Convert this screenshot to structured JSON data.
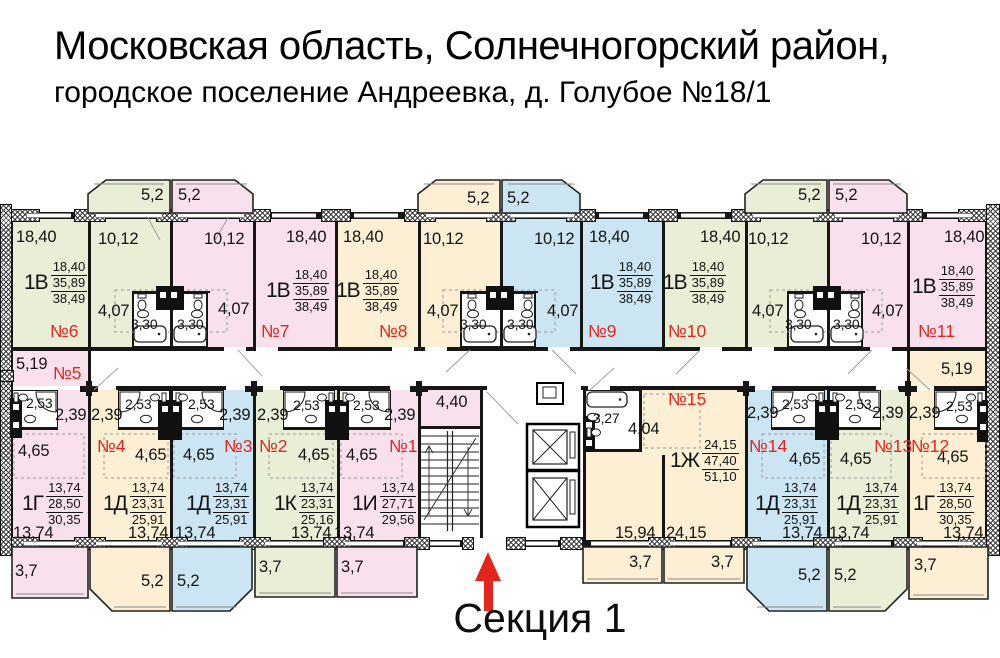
{
  "title": {
    "line1": "Московская область, Солнечногорский район,",
    "line2": "городское поселение Андреевка, д. Голубое №18/1"
  },
  "section": {
    "label": "Секция 1"
  },
  "palette": {
    "pink": "#f9e0ed",
    "green": "#e9eed7",
    "beige": "#fcefd3",
    "blue": "#cbe5f3",
    "red": "#e4251e",
    "wall": "#161616"
  },
  "apartments": [
    {
      "number": "№1",
      "type": "1И",
      "areas": [
        "13,74",
        "27,71",
        "29,56"
      ],
      "color": "pink"
    },
    {
      "number": "№2",
      "type": "1К",
      "areas": [
        "13,74",
        "23,31",
        "25,16"
      ],
      "color": "green"
    },
    {
      "number": "№3",
      "type": "1Д",
      "areas": [
        "13,74",
        "23,31",
        "25,91"
      ],
      "color": "blue"
    },
    {
      "number": "№4",
      "type": "1Д",
      "areas": [
        "13,74",
        "23,31",
        "25,91"
      ],
      "color": "beige"
    },
    {
      "number": "№5",
      "type": "1Г",
      "areas": [
        "13,74",
        "28,50",
        "30,35"
      ],
      "color": "pink"
    },
    {
      "number": "№6",
      "type": "1В",
      "areas": [
        "18,40",
        "35,89",
        "38,49"
      ],
      "color": "green"
    },
    {
      "number": "№7",
      "type": "1В",
      "areas": [
        "18,40",
        "35,89",
        "38,49"
      ],
      "color": "pink"
    },
    {
      "number": "№8",
      "type": "1В",
      "areas": [
        "18,40",
        "35,89",
        "38,49"
      ],
      "color": "beige"
    },
    {
      "number": "№9",
      "type": "1В",
      "areas": [
        "18,40",
        "35,89",
        "38,49"
      ],
      "color": "blue"
    },
    {
      "number": "№10",
      "type": "1В",
      "areas": [
        "18,40",
        "35,89",
        "38,49"
      ],
      "color": "green"
    },
    {
      "number": "№11",
      "type": "1В",
      "areas": [
        "18,40",
        "35,89",
        "38,49"
      ],
      "color": "pink"
    },
    {
      "number": "№12",
      "type": "1Г",
      "areas": [
        "13,74",
        "28,50",
        "30,35"
      ],
      "color": "beige"
    },
    {
      "number": "№13",
      "type": "1Д",
      "areas": [
        "13,74",
        "23,31",
        "25,91"
      ],
      "color": "green"
    },
    {
      "number": "№14",
      "type": "1Д",
      "areas": [
        "13,74",
        "23,31",
        "25,91"
      ],
      "color": "blue"
    },
    {
      "number": "№15",
      "type": "1Ж",
      "areas": [
        "24,15",
        "47,40",
        "51,10"
      ],
      "color": "beige"
    }
  ],
  "labels": [
    {
      "t": "5,2",
      "x": 141,
      "y": 187
    },
    {
      "t": "5,2",
      "x": 178,
      "y": 187
    },
    {
      "t": "5,2",
      "x": 467,
      "y": 190
    },
    {
      "t": "5,2",
      "x": 507,
      "y": 190
    },
    {
      "t": "5,2",
      "x": 798,
      "y": 187
    },
    {
      "t": "5,2",
      "x": 835,
      "y": 187
    },
    {
      "t": "18,40",
      "x": 16,
      "y": 229
    },
    {
      "t": "10,12",
      "x": 98,
      "y": 231
    },
    {
      "t": "10,12",
      "x": 204,
      "y": 231
    },
    {
      "t": "18,40",
      "x": 286,
      "y": 229
    },
    {
      "t": "18,40",
      "x": 343,
      "y": 229
    },
    {
      "t": "10,12",
      "x": 423,
      "y": 231
    },
    {
      "t": "10,12",
      "x": 534,
      "y": 231
    },
    {
      "t": "18,40",
      "x": 589,
      "y": 229
    },
    {
      "t": "18,40",
      "x": 700,
      "y": 229
    },
    {
      "t": "10,12",
      "x": 748,
      "y": 231
    },
    {
      "t": "10,12",
      "x": 861,
      "y": 231
    },
    {
      "t": "18,40",
      "x": 944,
      "y": 229
    },
    {
      "t": "4,07",
      "x": 98,
      "y": 303
    },
    {
      "t": "3,30",
      "x": 131,
      "y": 317,
      "s": 14
    },
    {
      "t": "3,30",
      "x": 177,
      "y": 317,
      "s": 14
    },
    {
      "t": "4,07",
      "x": 218,
      "y": 301
    },
    {
      "t": "4,07",
      "x": 427,
      "y": 303
    },
    {
      "t": "3,30",
      "x": 460,
      "y": 317,
      "s": 14
    },
    {
      "t": "3,30",
      "x": 507,
      "y": 317,
      "s": 14
    },
    {
      "t": "4,07",
      "x": 547,
      "y": 303
    },
    {
      "t": "4,07",
      "x": 752,
      "y": 303
    },
    {
      "t": "3,30",
      "x": 785,
      "y": 317,
      "s": 14
    },
    {
      "t": "3,30",
      "x": 833,
      "y": 317,
      "s": 14
    },
    {
      "t": "4,07",
      "x": 872,
      "y": 303
    },
    {
      "t": "5,19",
      "x": 16,
      "y": 356
    },
    {
      "t": "5,19",
      "x": 941,
      "y": 361
    },
    {
      "t": "2,53",
      "x": 26,
      "y": 396,
      "s": 14
    },
    {
      "t": "2,39",
      "x": 55,
      "y": 407
    },
    {
      "t": "4,65",
      "x": 18,
      "y": 443
    },
    {
      "t": "13,74",
      "x": 13,
      "y": 525
    },
    {
      "t": "2,53",
      "x": 125,
      "y": 397,
      "s": 14
    },
    {
      "t": "2,39",
      "x": 91,
      "y": 407
    },
    {
      "t": "4,65",
      "x": 135,
      "y": 447
    },
    {
      "t": "13,74",
      "x": 128,
      "y": 525
    },
    {
      "t": "2,53",
      "x": 188,
      "y": 397,
      "s": 14
    },
    {
      "t": "2,39",
      "x": 219,
      "y": 407
    },
    {
      "t": "4,65",
      "x": 183,
      "y": 447
    },
    {
      "t": "13,74",
      "x": 175,
      "y": 525
    },
    {
      "t": "2,53",
      "x": 293,
      "y": 398,
      "s": 14
    },
    {
      "t": "2,39",
      "x": 257,
      "y": 407
    },
    {
      "t": "4,65",
      "x": 298,
      "y": 447
    },
    {
      "t": "13,74",
      "x": 291,
      "y": 525
    },
    {
      "t": "2,53",
      "x": 353,
      "y": 398,
      "s": 14
    },
    {
      "t": "2,39",
      "x": 384,
      "y": 407
    },
    {
      "t": "4,65",
      "x": 346,
      "y": 447
    },
    {
      "t": "13,74",
      "x": 334,
      "y": 525
    },
    {
      "t": "4,40",
      "x": 436,
      "y": 394
    },
    {
      "t": "3,27",
      "x": 593,
      "y": 411,
      "s": 14
    },
    {
      "t": "4,04",
      "x": 628,
      "y": 421
    },
    {
      "t": "15,94",
      "x": 615,
      "y": 525
    },
    {
      "t": "24,15",
      "x": 666,
      "y": 525
    },
    {
      "t": "2,39",
      "x": 747,
      "y": 405
    },
    {
      "t": "2,53",
      "x": 782,
      "y": 397,
      "s": 14
    },
    {
      "t": "4,65",
      "x": 789,
      "y": 451
    },
    {
      "t": "13,74",
      "x": 782,
      "y": 525
    },
    {
      "t": "2,53",
      "x": 845,
      "y": 397,
      "s": 14
    },
    {
      "t": "2,39",
      "x": 872,
      "y": 405
    },
    {
      "t": "4,65",
      "x": 840,
      "y": 451
    },
    {
      "t": "13,74",
      "x": 829,
      "y": 525
    },
    {
      "t": "2,39",
      "x": 909,
      "y": 405
    },
    {
      "t": "2,53",
      "x": 946,
      "y": 399,
      "s": 14
    },
    {
      "t": "4,65",
      "x": 937,
      "y": 449
    },
    {
      "t": "13,74",
      "x": 943,
      "y": 525
    },
    {
      "t": "3,7",
      "x": 15,
      "y": 563
    },
    {
      "t": "5,2",
      "x": 141,
      "y": 573
    },
    {
      "t": "5,2",
      "x": 177,
      "y": 573
    },
    {
      "t": "3,7",
      "x": 259,
      "y": 559
    },
    {
      "t": "3,7",
      "x": 341,
      "y": 559
    },
    {
      "t": "3,7",
      "x": 629,
      "y": 554
    },
    {
      "t": "3,7",
      "x": 711,
      "y": 554
    },
    {
      "t": "5,2",
      "x": 798,
      "y": 567
    },
    {
      "t": "5,2",
      "x": 834,
      "y": 567
    },
    {
      "t": "3,7",
      "x": 914,
      "y": 557
    }
  ]
}
